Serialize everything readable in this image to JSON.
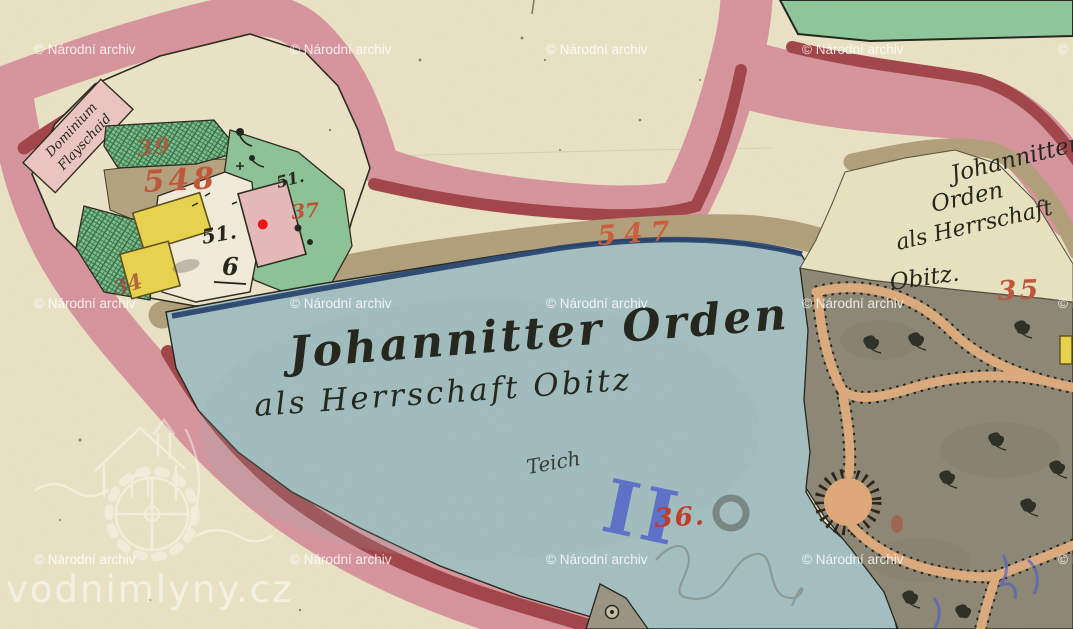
{
  "watermark": {
    "label": "© Národní archiv",
    "brand": "vodnimlyny.cz",
    "logo": "mill-house-waterwheel"
  },
  "pond": {
    "owner_line1": "Johannitter Orden",
    "owner_line2": "als Herrschaft Obitz",
    "type_label": "Teich",
    "blue_numeral": "II",
    "parcel_number": "36."
  },
  "shore": {
    "road_number": "547"
  },
  "farm": {
    "estate_line1": "Dominium",
    "estate_line2": "Flayschaid",
    "yard_road_number": "548",
    "garden_number_upper": "39",
    "garden_number_lower": "34",
    "garden_number_east": "37",
    "green_house_number": "51.",
    "court_house_number": "51.",
    "court_house_subnumber": "6"
  },
  "east_parcel": {
    "line1": "Johannitter",
    "line2": "Orden",
    "line3": "als Herrschaft",
    "line4": "Obitz.",
    "number": "35"
  },
  "colors": {
    "paper": "#ebe3c6",
    "boundary_pink": "#d7959e",
    "boundary_dark_red": "#a2454a",
    "road_tan": "#b2a07c",
    "pond_blue": "#a5c0c2",
    "pond_edge_navy": "#24416e",
    "meadow_green": "#8fc79b",
    "garden_green": "#7fbd8d",
    "park_grey": "#8d8775",
    "path_peach": "#dcab7e",
    "building_yellow": "#e9d44e",
    "building_pink": "#e6baba",
    "red_number": "#c0563a",
    "marker_red_dot": "#ee1313",
    "survey_blue": "#4a5ccd",
    "ink_black": "#23251c",
    "watermark_white": "#ffffff"
  }
}
